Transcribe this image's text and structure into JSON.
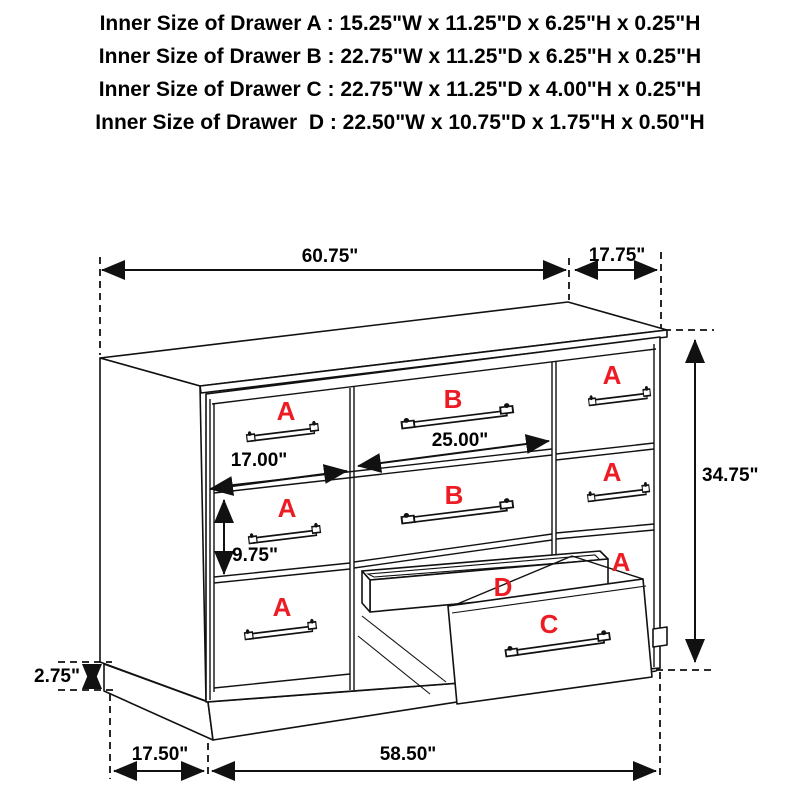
{
  "spec": {
    "lines": [
      "Inner Size of Drawer A : 15.25\"W x 11.25\"D x 6.25\"H x 0.25\"H",
      "Inner Size of Drawer B : 22.75\"W x 11.25\"D x 6.25\"H x 0.25\"H",
      "Inner Size of Drawer C : 22.75\"W x 11.25\"D x 4.00\"H x 0.25\"H",
      "Inner Size of Drawer  D : 22.50\"W x 10.75\"D x 1.75\"H x 0.50\"H"
    ]
  },
  "dimensions": {
    "top_width": "60.75\"",
    "top_depth": "17.75\"",
    "height": "34.75\"",
    "drawer_a_width": "17.00\"",
    "drawer_b_width": "25.00\"",
    "drawer_a_height": "9.75\"",
    "base_height": "2.75\"",
    "base_depth": "17.50\"",
    "base_width": "58.50\""
  },
  "drawer_labels": {
    "a": "A",
    "b": "B",
    "c": "C",
    "d": "D"
  },
  "colors": {
    "label_red": "#ed1c24",
    "line_black": "#111111",
    "background": "#ffffff"
  }
}
